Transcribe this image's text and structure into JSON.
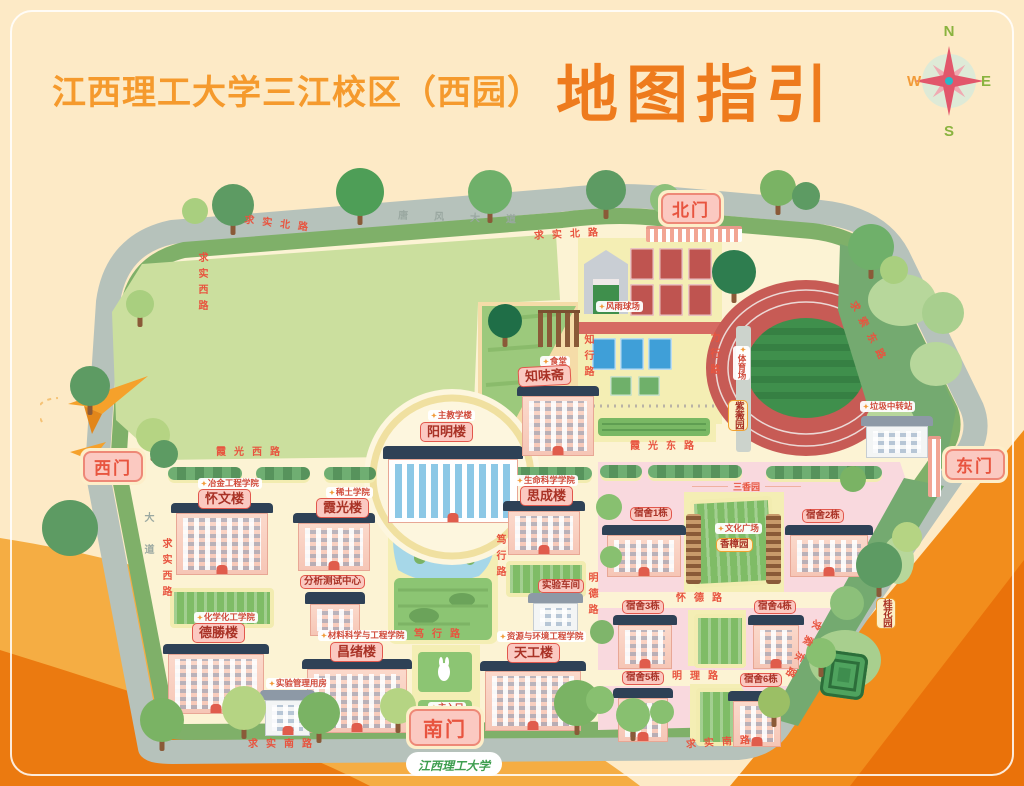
{
  "title": {
    "campus": "江西理工大学三江校区（西园）",
    "main": "地图指引"
  },
  "compass": {
    "n": "N",
    "e": "E",
    "s": "S",
    "w": "W"
  },
  "gates": {
    "north": "北门",
    "south": "南门",
    "east": "东门",
    "west": "西门"
  },
  "buildings": {
    "yangming": "阳明楼",
    "zhiweizhai": "知味斋",
    "huaiwen": "怀文楼",
    "xiaguang": "霞光楼",
    "sicheng": "思成楼",
    "desheng": "德勝楼",
    "changxu": "昌绪楼",
    "tiangong": "天工楼",
    "analysis_center": "分析测试中心",
    "lab_mgmt": "实验管理用房",
    "workshop": "实验车间"
  },
  "colleges": {
    "main_teaching": "主教学楼",
    "canteen": "食堂",
    "metallurgy": "冶金工程学院",
    "rare_earth": "稀土学院",
    "life_science": "生命科学学院",
    "chemistry": "化学化工学院",
    "materials": "材料科学与工程学院",
    "resources": "资源与环境工程学院"
  },
  "dorms": [
    "宿舍1栋",
    "宿舍2栋",
    "宿舍3栋",
    "宿舍4栋",
    "宿舍5栋",
    "宿舍6栋"
  ],
  "areas": {
    "stadium": "体育场",
    "rainproof_court": "风雨球场",
    "culture_square": "文化广场",
    "sanxiang_garden": "三香园",
    "camphor_garden": "香樟园",
    "ziwei_garden": "紫薇园",
    "osmanthus_garden": "桂花园",
    "garbage_station": "垃圾中转站",
    "main_entrance": "主入口"
  },
  "roads": {
    "qiushi_north": "求实北路",
    "qiushi_west": "求实西路",
    "qiushi_south": "求实南路",
    "qiusuo_east": "求索东路",
    "xiaguang_west": "霞光西路",
    "xiaguang_east": "霞光东路",
    "duxing": "笃行路",
    "mingli": "明理路",
    "huaide": "怀德路",
    "mingde": "明德路",
    "zhixing": "知行路",
    "lixing": "力行路",
    "outer_avenue": "唐风大道",
    "outer_avenue_side": "大道"
  },
  "footer": {
    "signature": "江西理工大学"
  },
  "colors": {
    "accent_orange": "#ee7b1d",
    "label_pink": "#fbc9c1",
    "label_border": "#e2574c",
    "road_text": "#e8543f",
    "track_red": "#c75b55",
    "dorm_pink": "#f9d9de",
    "border_green": "#7fb069"
  }
}
